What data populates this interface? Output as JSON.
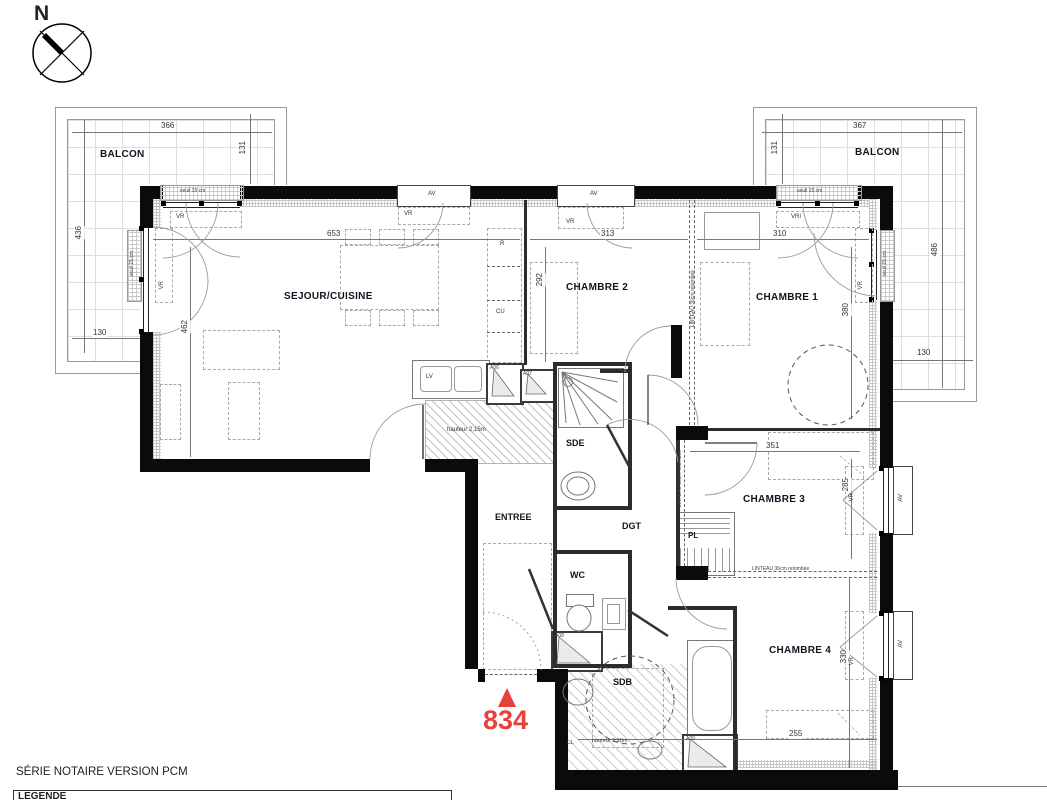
{
  "compass": {
    "north": "N"
  },
  "balcony_left": {
    "label": "BALCON",
    "dim_top": "366",
    "dim_side": "131",
    "dim_left": "436",
    "dim_bottom": "130"
  },
  "balcony_right": {
    "label": "BALCON",
    "dim_top": "367",
    "dim_side": "131",
    "dim_right": "486",
    "dim_bottom": "130"
  },
  "rooms": {
    "sejour": "SEJOUR/CUISINE",
    "chambre1": "CHAMBRE 1",
    "chambre2": "CHAMBRE 2",
    "chambre3": "CHAMBRE 3",
    "chambre4": "CHAMBRE 4",
    "sde": "SDE",
    "wc": "WC",
    "sdb": "SDB",
    "entree": "ENTREE",
    "dgt": "DGT",
    "placard": "PL"
  },
  "dimensions": {
    "sejour_width": "653",
    "sejour_depth": "462",
    "chambre2_width": "313",
    "chambre2_depth": "292",
    "chambre1_width": "310",
    "chambre1_depth": "380",
    "chambre3_width": "351",
    "chambre3_depth": "285",
    "chambre4_width": "255",
    "chambre4_depth": "330"
  },
  "annotations": {
    "seuil": "seuil 15 cm",
    "linteau": "LINTEAU 36cm retombée",
    "vr": "VR",
    "vri": "VRI",
    "av": "AV",
    "refrigerator": "R",
    "cuisine": "CU",
    "lave_vaisselle": "LV",
    "lave_linge": "LL",
    "a06": "A06",
    "a07": "A07",
    "a08": "A08",
    "a09": "A09",
    "hauteur_cuisine": "hauteur 2,15m",
    "hauteur_sdb": "hauteur 2,20m"
  },
  "lot": {
    "number": "834",
    "marker_color": "#e8413c"
  },
  "footer": {
    "series": "SÉRIE NOTAIRE VERSION PCM",
    "legend": "LEGENDE"
  }
}
